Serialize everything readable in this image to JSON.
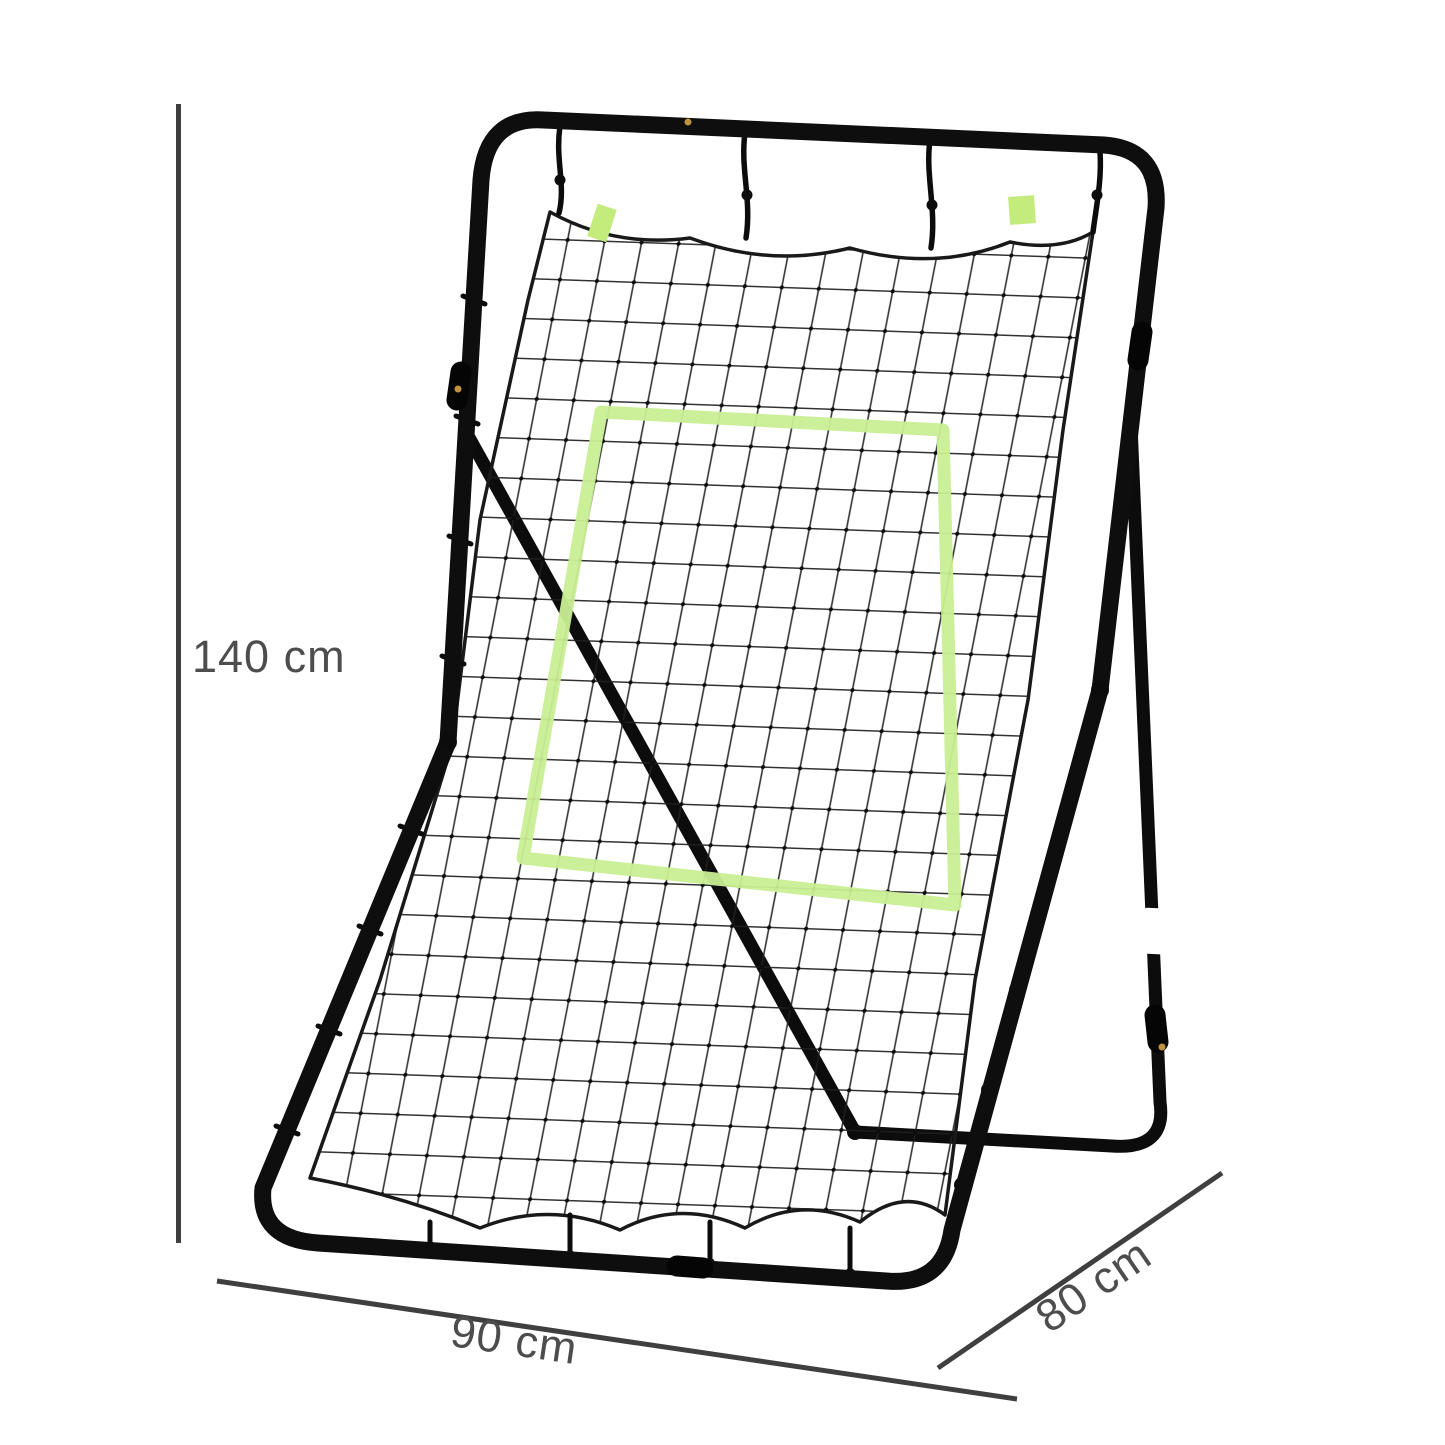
{
  "page": {
    "background": "#ffffff"
  },
  "product": {
    "frame_color": "#0e0e0e",
    "rear_frame_color": "#0c0c0c",
    "net_rope_color": "#191919",
    "net_mesh_color": "#202020",
    "target_zone_color": "#c9ef95",
    "tag_color": "#c4ec7d",
    "leg_band_color": "#ffffff",
    "screw_color": "#bf9440"
  },
  "dimensions": {
    "height": {
      "label": "140 cm"
    },
    "width": {
      "label": "90 cm"
    },
    "depth": {
      "label": "80 cm"
    },
    "line_color": "#3f3f3f",
    "text_color": "#4d4d4d"
  }
}
